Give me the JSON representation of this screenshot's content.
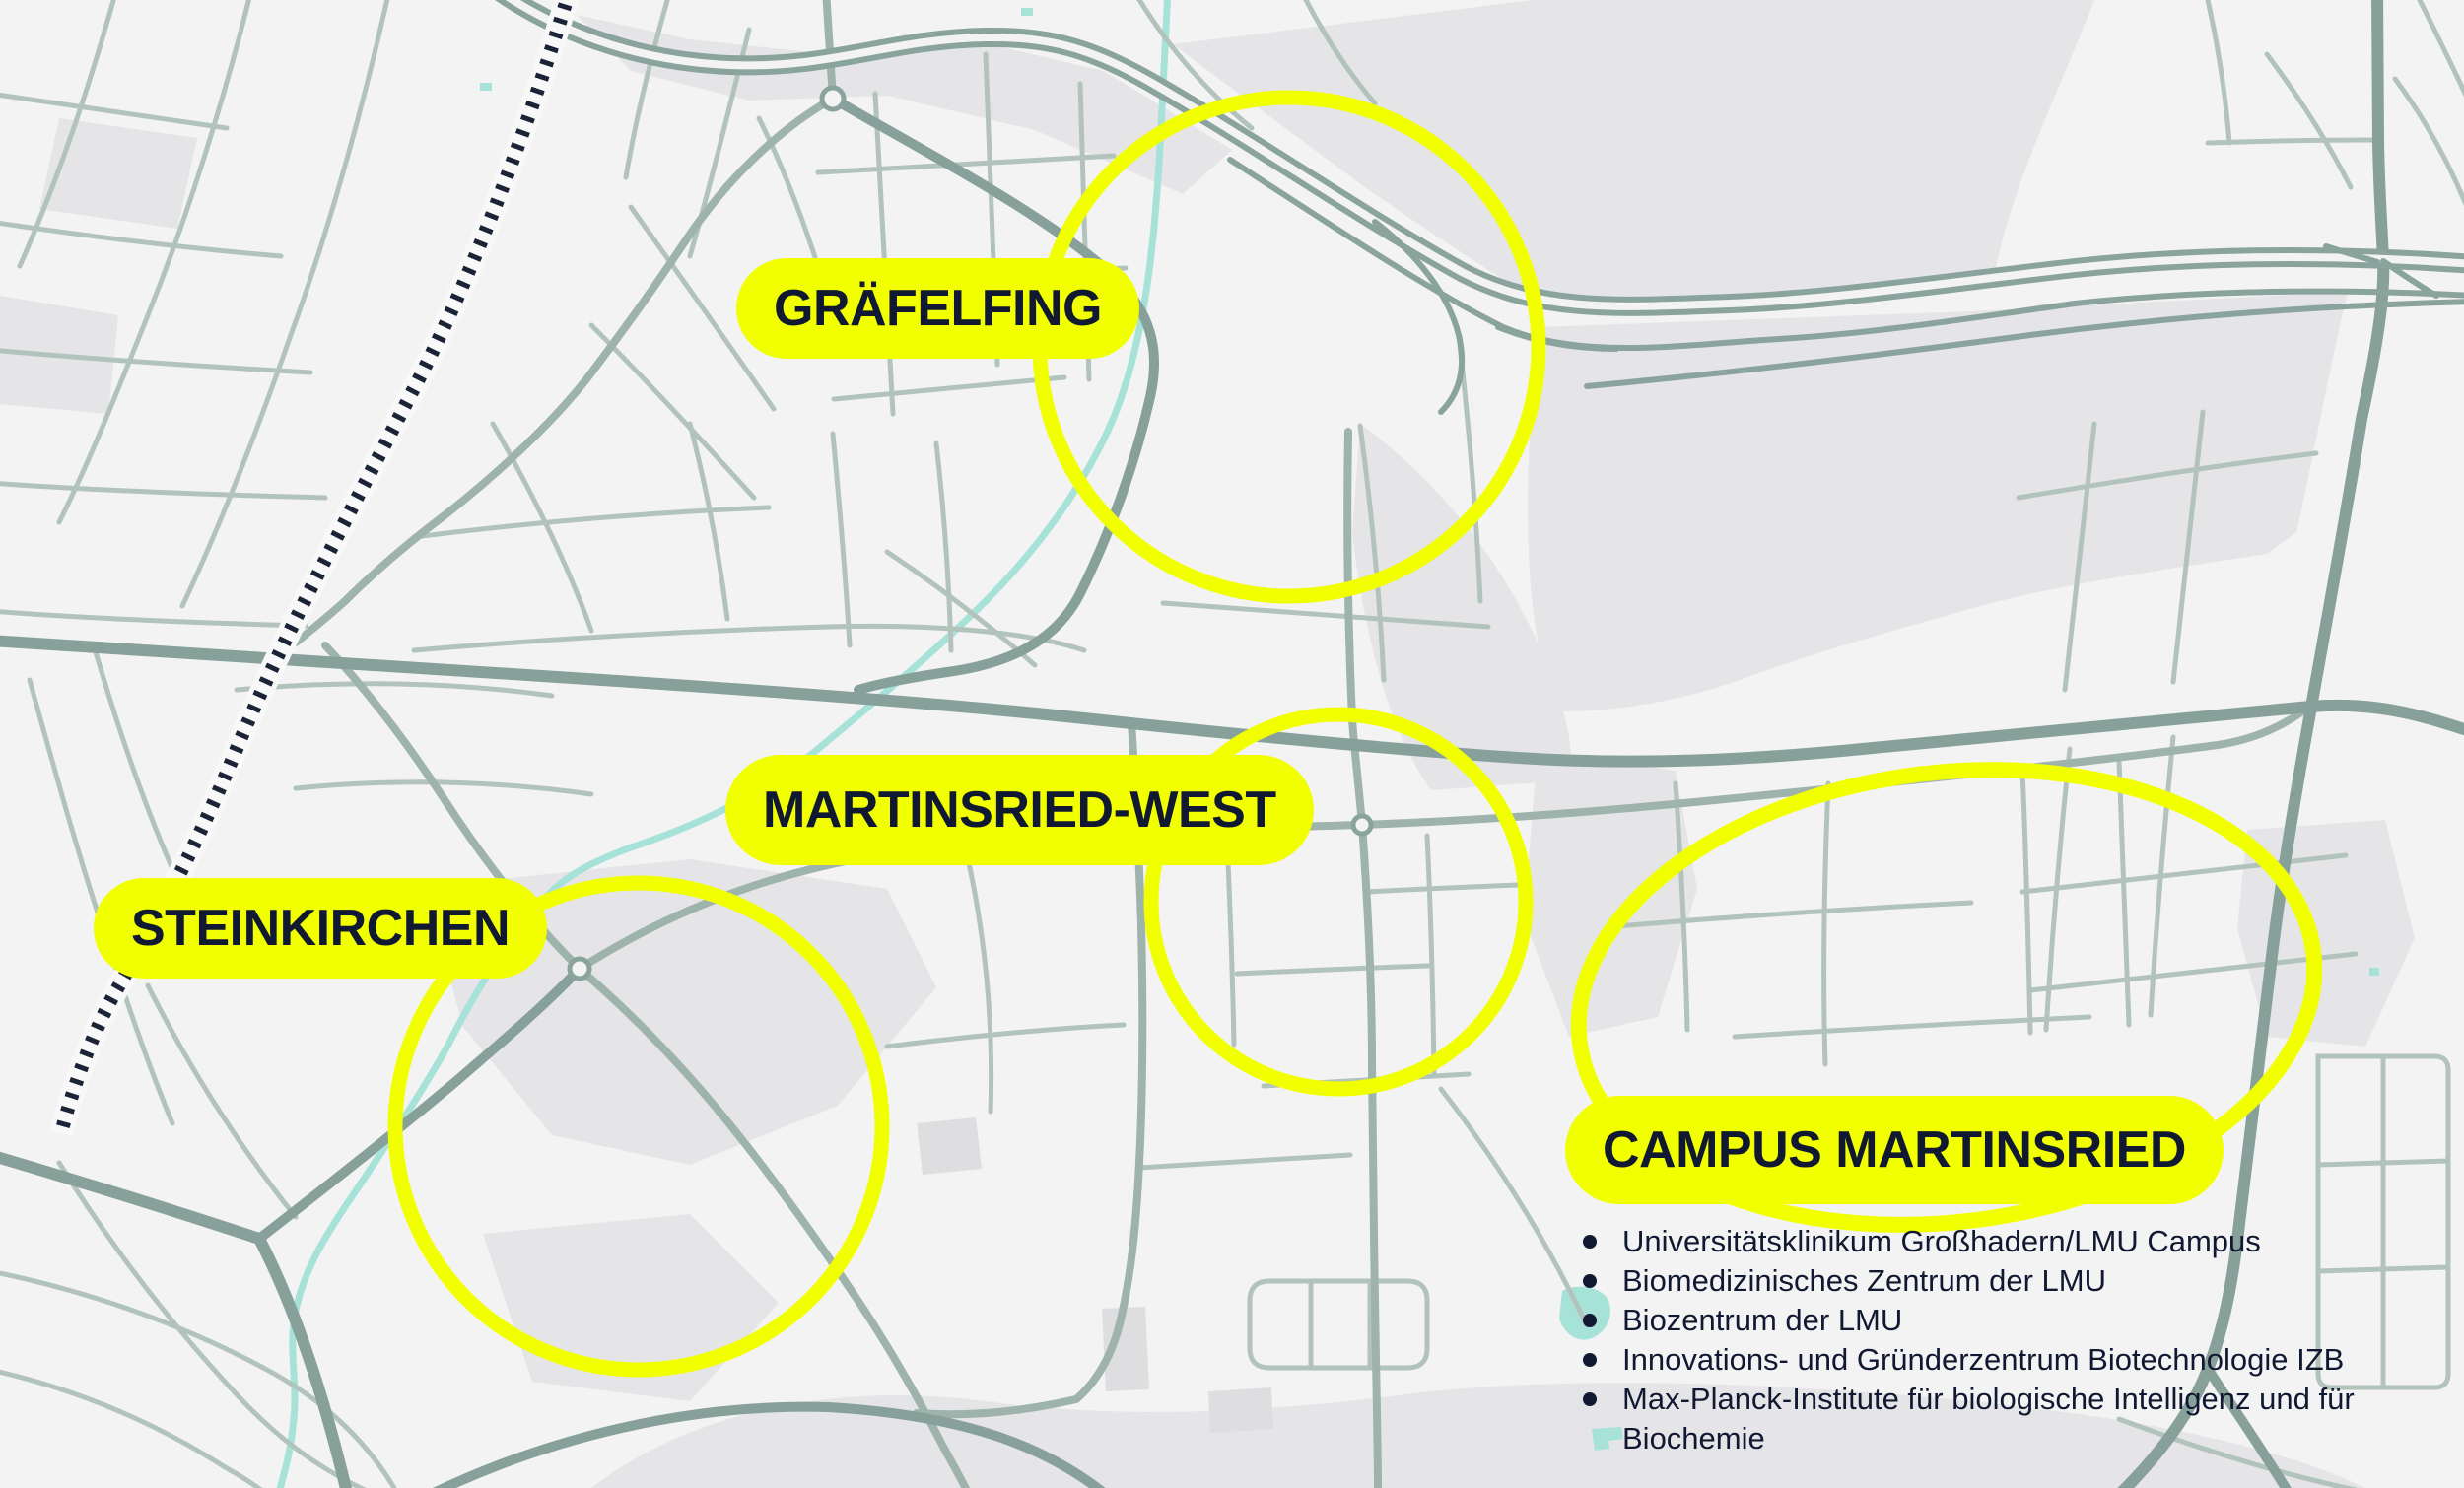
{
  "map": {
    "labels": {
      "graefelfing": "GRÄFELFING",
      "martinsried_west": "MARTINSRIED-WEST",
      "steinkirchen": "STEINKIRCHEN",
      "campus_martinsried": "CAMPUS MARTINSRIED"
    },
    "campus_institutions": [
      "Universitätsklinikum Großhadern/LMU Campus",
      "Biomedizinisches Zentrum der LMU",
      "Biozentrum der LMU",
      "Innovations- und Gründerzentrum Biotechnologie IZB",
      "Max-Planck-Institute für biologische Intelligenz und für Biochemie"
    ],
    "colors": {
      "highlight_yellow": "#F1FF00",
      "label_text": "#111831",
      "background": "#F3F3F4",
      "land_patch": "#E5E5E7",
      "road_minor": "#B2C3BC",
      "road_major": "#87A19A",
      "railway": "#1B2336",
      "water": "#A7E2D9"
    }
  }
}
